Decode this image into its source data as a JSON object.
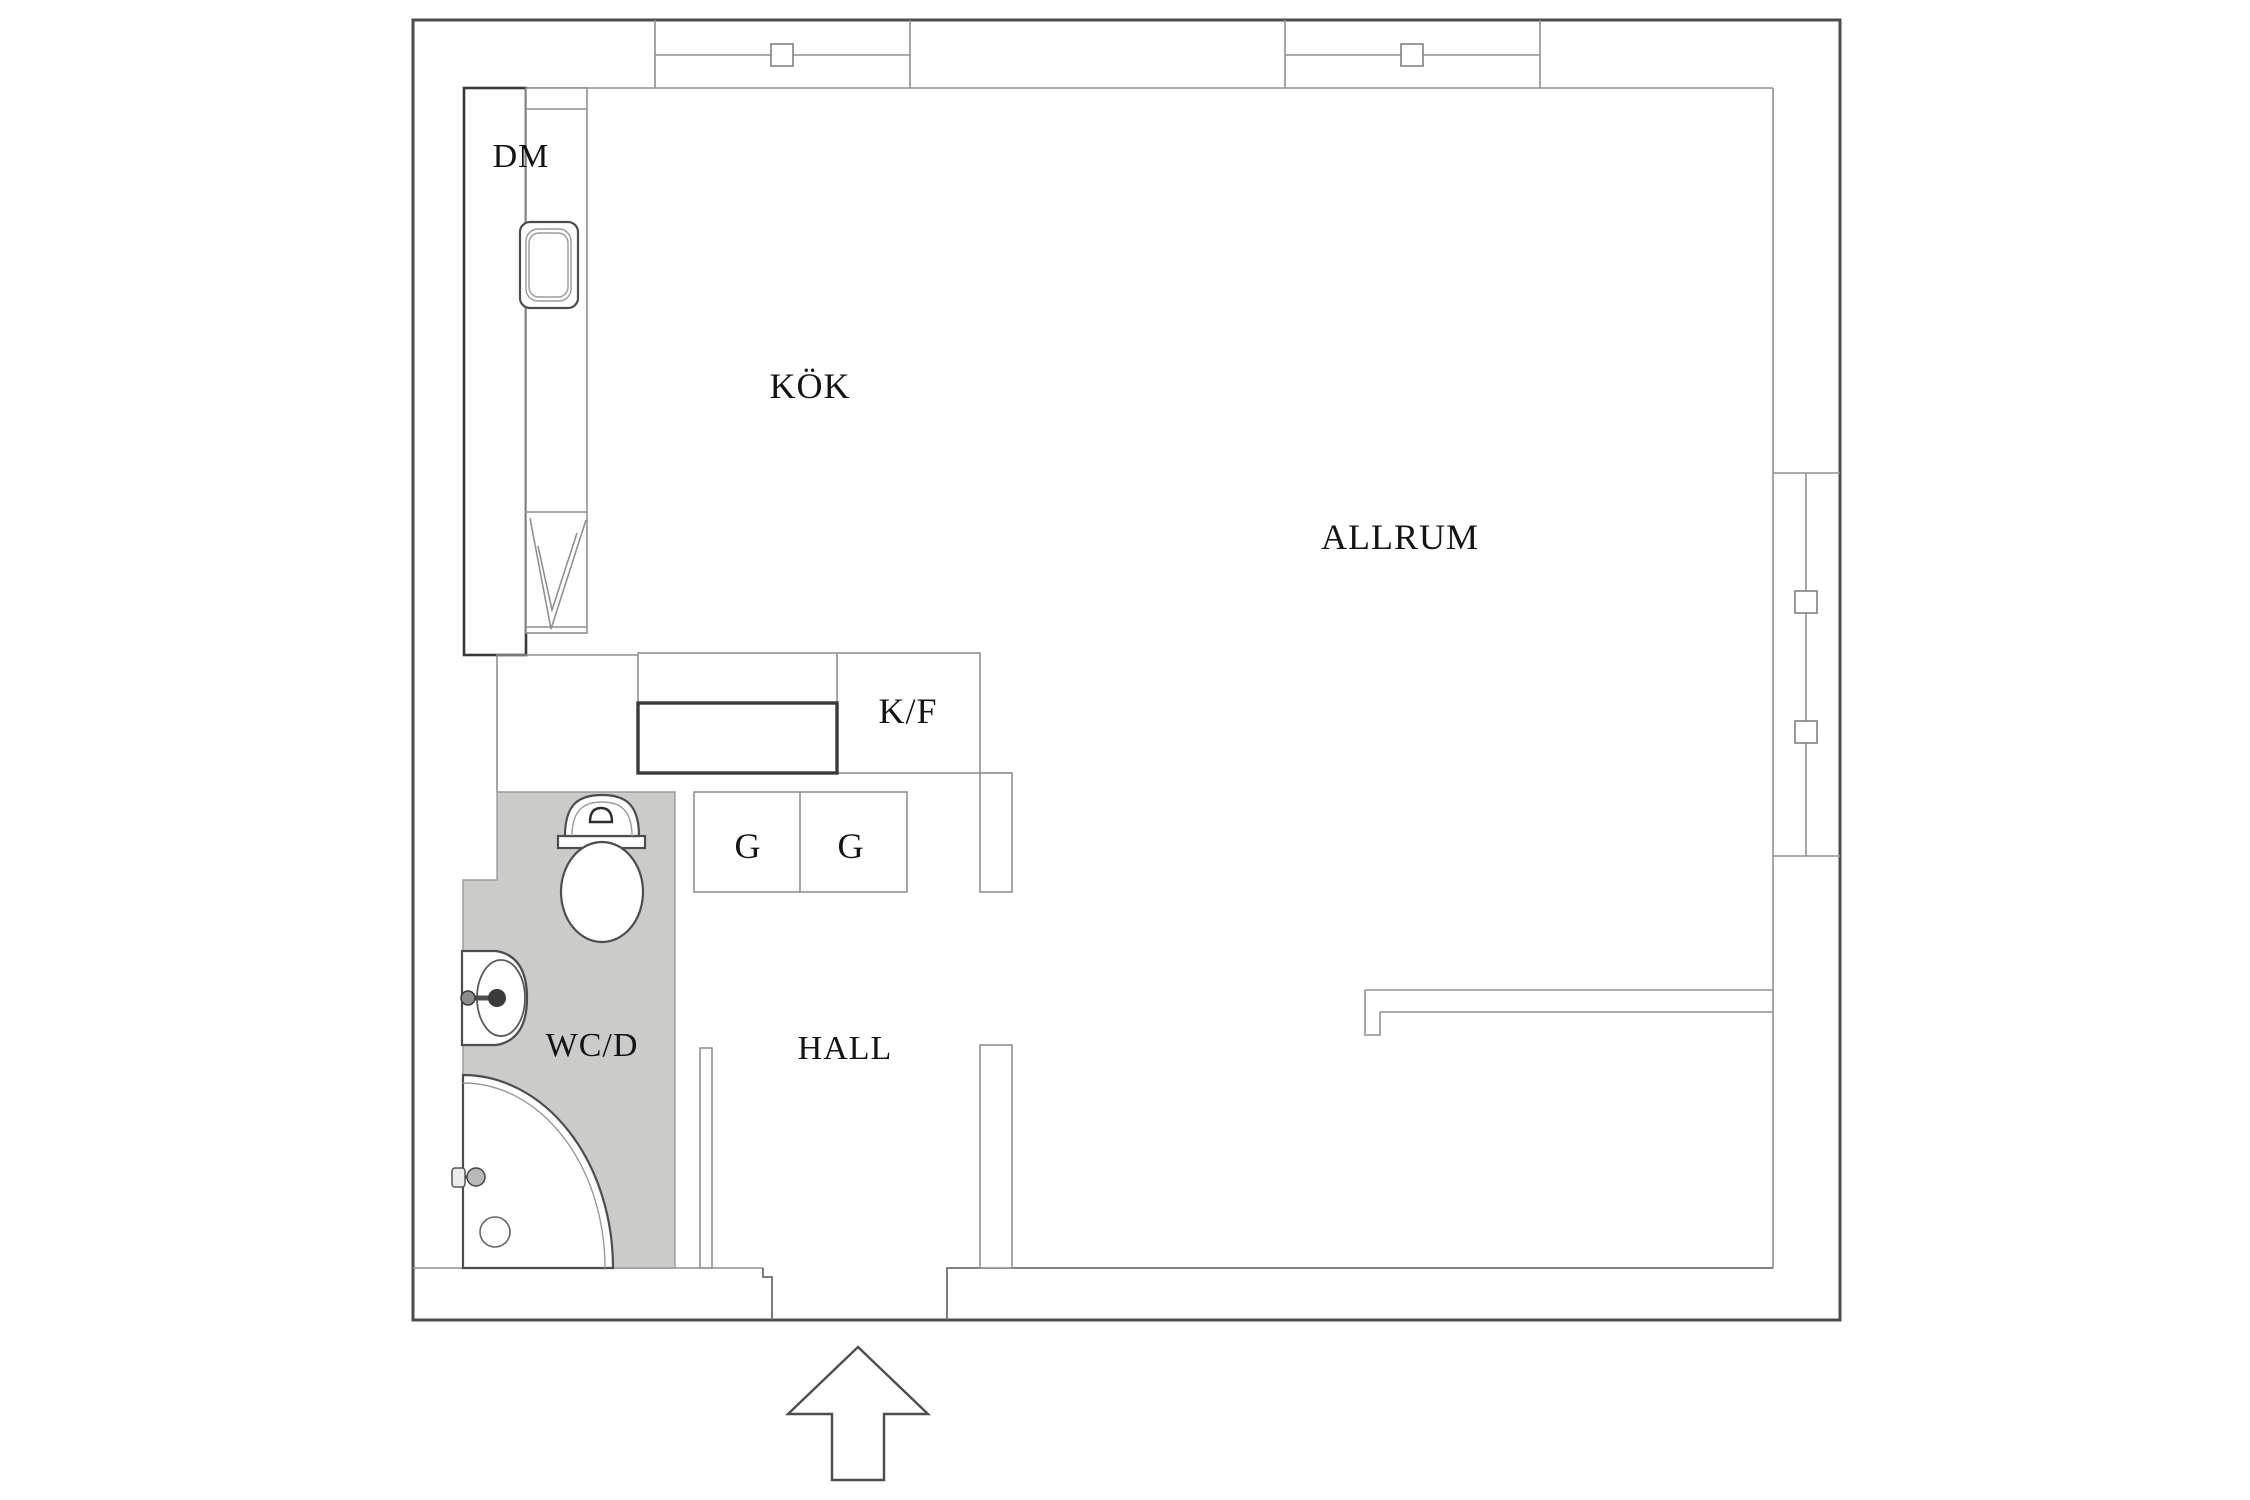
{
  "plan": {
    "type": "apartment-floor-plan",
    "rooms": {
      "kitchen": {
        "label": "KÖK"
      },
      "living_room": {
        "label": "ALLRUM"
      },
      "hall": {
        "label": "HALL"
      },
      "bathroom": {
        "label": "WC/D"
      }
    },
    "fixtures": {
      "dishwasher": {
        "label": "DM"
      },
      "fridge_freezer": {
        "label": "K/F"
      },
      "wardrobe_1": {
        "label": "G"
      },
      "wardrobe_2": {
        "label": "G"
      }
    },
    "symbols": {
      "entrance_arrow": "entrance-direction-arrow",
      "window_top_count": 2,
      "window_right_count": 1,
      "shower": "quarter-circle-shower",
      "toilet": "toilet",
      "washbasin": "washbasin-with-faucet",
      "kitchen_sink": "single-bowl-sink",
      "drainboard": "drainboard-check-symbol",
      "floor_drain": "floor-drain"
    },
    "colors": {
      "wall_line": "#4d4d4d",
      "thin_line": "#909090",
      "dark_line": "#3a3a3a",
      "bathroom_floor": "#cbcbca",
      "label_text": "#141414",
      "background": "#ffffff"
    }
  }
}
